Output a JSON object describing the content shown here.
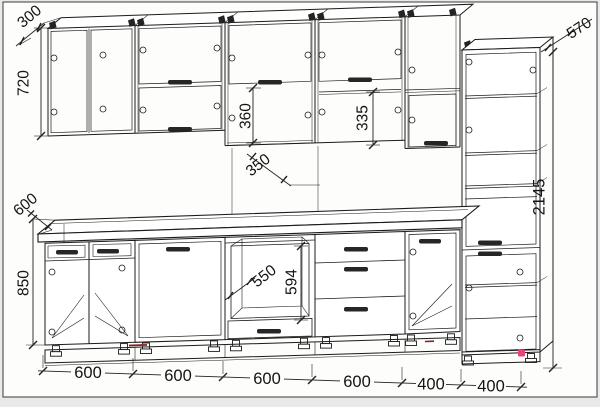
{
  "drawing": {
    "kind": "kitchen-cabinet-technical-drawing",
    "background": "#fdfdfb",
    "margin_background": "#e9e9e7",
    "line_color": "#1b1b1b",
    "accents": {
      "plinth_mark": "#8a1f1f",
      "corner_marker": "#e8437a"
    }
  },
  "dimensions": {
    "wall_depth": "300",
    "wall_height": "720",
    "counter_depth": "600",
    "base_height": "850",
    "niche_height": "360",
    "niche_width": "350",
    "opening_height": "335",
    "tall_depth": "570",
    "total_height": "2145",
    "oven_depth": "550",
    "oven_opening_height": "594",
    "bottom_chain": [
      "600",
      "600",
      "600",
      "600",
      "400",
      "400"
    ]
  }
}
